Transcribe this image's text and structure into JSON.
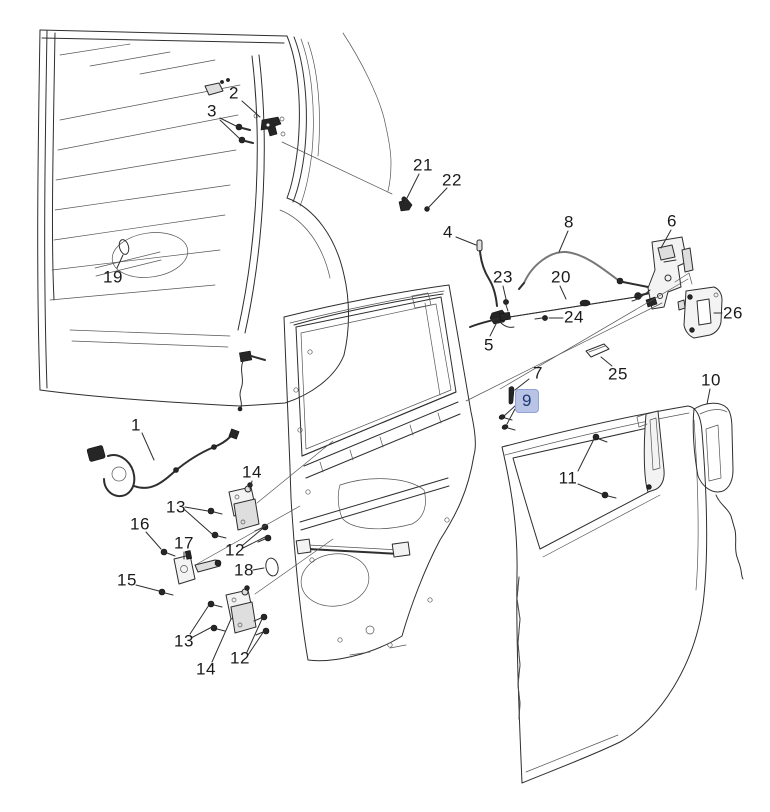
{
  "diagram": {
    "title": "Rear door hardware exploded-view parts diagram",
    "canvas": {
      "width": 770,
      "height": 812,
      "background": "#ffffff"
    },
    "style": {
      "line_color": "#2e2e2e",
      "label_color": "#1a1a1a",
      "label_font_size": 17,
      "leader_width": 1.1
    },
    "highlight": {
      "fill": "#b9c3e6",
      "border": "#8fa3d8",
      "text": "#1f3a70"
    },
    "selected_callout": "9",
    "callouts": [
      {
        "label": "2",
        "x": 234,
        "y": 93,
        "highlighted": false,
        "leaders": [
          [
            242,
            101,
            260,
            117
          ]
        ]
      },
      {
        "label": "3",
        "x": 212,
        "y": 111,
        "highlighted": false,
        "leaders": [
          [
            220,
            118,
            236,
            126
          ],
          [
            220,
            120,
            239,
            138
          ]
        ]
      },
      {
        "label": "19",
        "x": 113,
        "y": 277,
        "highlighted": false,
        "leaders": [
          [
            117,
            268,
            123,
            255
          ]
        ]
      },
      {
        "label": "21",
        "x": 423,
        "y": 165,
        "highlighted": false,
        "leaders": [
          [
            419,
            174,
            405,
            202
          ]
        ]
      },
      {
        "label": "22",
        "x": 452,
        "y": 180,
        "highlighted": false,
        "leaders": [
          [
            447,
            188,
            429,
            207
          ]
        ]
      },
      {
        "label": "4",
        "x": 448,
        "y": 232,
        "highlighted": false,
        "leaders": [
          [
            456,
            237,
            476,
            245
          ]
        ]
      },
      {
        "label": "8",
        "x": 569,
        "y": 222,
        "highlighted": false,
        "leaders": [
          [
            568,
            231,
            559,
            252
          ]
        ]
      },
      {
        "label": "6",
        "x": 672,
        "y": 221,
        "highlighted": false,
        "leaders": [
          [
            671,
            230,
            661,
            248
          ]
        ]
      },
      {
        "label": "23",
        "x": 503,
        "y": 277,
        "highlighted": false,
        "leaders": [
          [
            503,
            286,
            506,
            299
          ]
        ]
      },
      {
        "label": "20",
        "x": 561,
        "y": 277,
        "highlighted": false,
        "leaders": [
          [
            560,
            286,
            566,
            299
          ]
        ]
      },
      {
        "label": "24",
        "x": 574,
        "y": 317,
        "highlighted": false,
        "leaders": [
          [
            563,
            318,
            549,
            318
          ]
        ]
      },
      {
        "label": "26",
        "x": 733,
        "y": 313,
        "highlighted": false,
        "leaders": [
          [
            722,
            313,
            714,
            313
          ]
        ]
      },
      {
        "label": "5",
        "x": 489,
        "y": 345,
        "highlighted": false,
        "leaders": [
          [
            490,
            336,
            497,
            322
          ]
        ]
      },
      {
        "label": "25",
        "x": 618,
        "y": 374,
        "highlighted": false,
        "leaders": [
          [
            612,
            366,
            601,
            357
          ]
        ]
      },
      {
        "label": "7",
        "x": 538,
        "y": 373,
        "highlighted": false,
        "leaders": [
          [
            529,
            379,
            515,
            390
          ]
        ]
      },
      {
        "label": "9",
        "x": 527,
        "y": 401,
        "highlighted": true,
        "leaders": [
          [
            515,
            406,
            504,
            416
          ],
          [
            515,
            409,
            507,
            424
          ]
        ]
      },
      {
        "label": "10",
        "x": 711,
        "y": 380,
        "highlighted": false,
        "leaders": [
          [
            710,
            389,
            707,
            404
          ]
        ]
      },
      {
        "label": "11",
        "x": 568,
        "y": 478,
        "highlighted": false,
        "leaders": [
          [
            578,
            471,
            594,
            439
          ],
          [
            578,
            484,
            602,
            494
          ]
        ]
      },
      {
        "label": "1",
        "x": 136,
        "y": 425,
        "highlighted": false,
        "leaders": [
          [
            142,
            433,
            154,
            460
          ]
        ]
      },
      {
        "label": "14",
        "x": 252,
        "y": 472,
        "highlighted": false,
        "leaders": [
          [
            252,
            481,
            250,
            489
          ]
        ]
      },
      {
        "label": "13",
        "x": 176,
        "y": 507,
        "highlighted": false,
        "leaders": [
          [
            185,
            507,
            208,
            511
          ],
          [
            185,
            510,
            212,
            534
          ]
        ]
      },
      {
        "label": "16",
        "x": 140,
        "y": 524,
        "highlighted": false,
        "leaders": [
          [
            146,
            532,
            161,
            549
          ]
        ]
      },
      {
        "label": "17",
        "x": 184,
        "y": 543,
        "highlighted": false,
        "leaders": [
          [
            184,
            552,
            184,
            559
          ]
        ]
      },
      {
        "label": "12",
        "x": 235,
        "y": 550,
        "highlighted": false,
        "leaders": [
          [
            243,
            545,
            262,
            529
          ],
          [
            243,
            548,
            265,
            537
          ]
        ]
      },
      {
        "label": "18",
        "x": 244,
        "y": 570,
        "highlighted": false,
        "leaders": [
          [
            253,
            570,
            264,
            568
          ]
        ]
      },
      {
        "label": "15",
        "x": 127,
        "y": 580,
        "highlighted": false,
        "leaders": [
          [
            136,
            585,
            159,
            591
          ]
        ]
      },
      {
        "label": "13",
        "x": 184,
        "y": 641,
        "highlighted": false,
        "leaders": [
          [
            190,
            634,
            209,
            605
          ],
          [
            191,
            638,
            212,
            627
          ]
        ]
      },
      {
        "label": "12",
        "x": 240,
        "y": 658,
        "highlighted": false,
        "leaders": [
          [
            247,
            652,
            262,
            619
          ],
          [
            248,
            655,
            264,
            631
          ]
        ]
      },
      {
        "label": "14",
        "x": 206,
        "y": 669,
        "highlighted": false,
        "leaders": [
          [
            212,
            662,
            231,
            619
          ]
        ]
      }
    ]
  }
}
